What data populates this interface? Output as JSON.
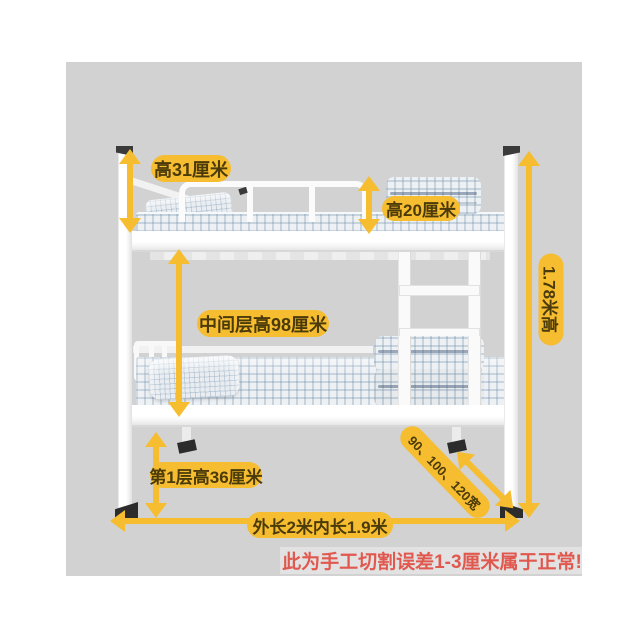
{
  "colors": {
    "stage_bg": "#d2d2d2",
    "label_bg": "#f5bd2f",
    "label_text": "#4b3a0a",
    "warning_text": "#e0584e",
    "frame_white": "#fbfbfb"
  },
  "labels": {
    "guardrail_height": "高31厘米",
    "bedding_height": "高20厘米",
    "middle_clearance": "中间层高98厘米",
    "total_height": "1.78米高",
    "first_layer_height": "第1层高36厘米",
    "length": "外长2米内长1.9米",
    "width_options": "90、100、120宽",
    "warning": "此为手工切割误差1-3厘米属于正常!"
  }
}
